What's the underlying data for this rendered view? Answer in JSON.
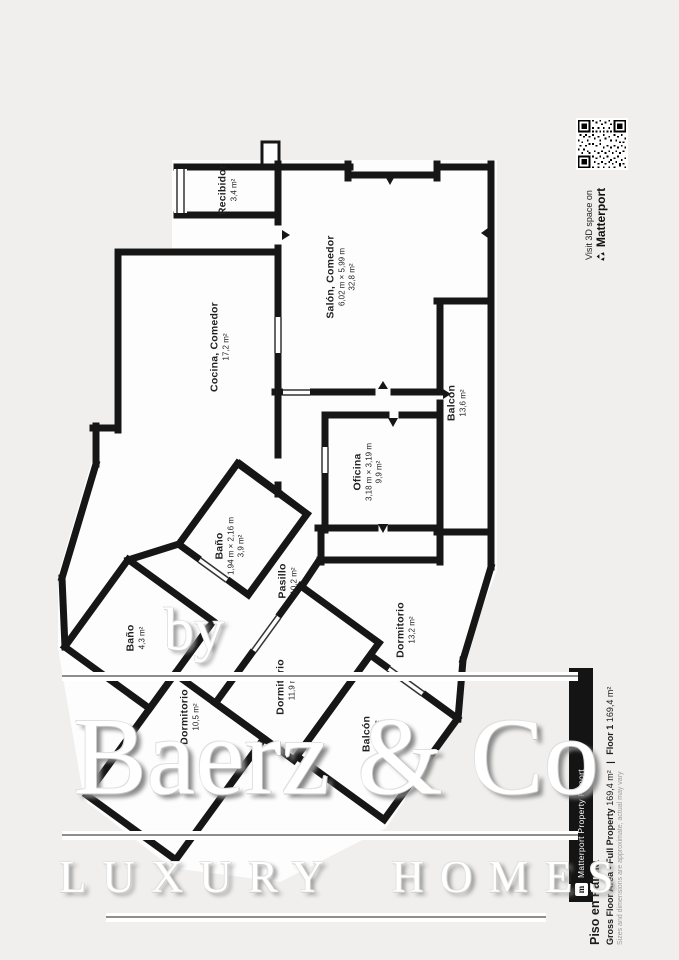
{
  "listing": {
    "title": "Piso en Palma",
    "area_label": "Gross Floor Area - Full Property",
    "area_value": "169,4 m²",
    "divider": "|",
    "floor_label": "Floor 1",
    "floor_value": "169,4 m²",
    "disclaimer": "Sizes and dimensions are approximate, actual may vary"
  },
  "matterport": {
    "visit_line": "Visit 3D space on",
    "brand": "Matterport",
    "banner": "Matterport Property Report",
    "logo_letter": "m"
  },
  "watermark": {
    "prefix": "by",
    "brand": "Baerz & Co",
    "tagline": "LUXURY HOMES"
  },
  "rooms": [
    {
      "name": "Recibidor",
      "dims": "",
      "area": "3,4 m²"
    },
    {
      "name": "Salón, Comedor",
      "dims": "6,02 m × 5,99 m",
      "area": "32,8 m²"
    },
    {
      "name": "Cocina, Comedor",
      "dims": "",
      "area": "17,2 m²"
    },
    {
      "name": "Balcón",
      "dims": "",
      "area": "13,6 m²"
    },
    {
      "name": "Oficina",
      "dims": "3,18 m × 3,19 m",
      "area": "9,9 m²"
    },
    {
      "name": "Baño",
      "dims": "1,94 m × 2,16 m",
      "area": "3,9 m²"
    },
    {
      "name": "Pasillo",
      "dims": "",
      "area": "10,2 m²"
    },
    {
      "name": "Dormitorio",
      "dims": "",
      "area": "13,2 m²"
    },
    {
      "name": "Baño",
      "dims": "",
      "area": "4,3 m²"
    },
    {
      "name": "Dormitorio",
      "dims": "",
      "area": "10,5 m²"
    },
    {
      "name": "Dormitorio",
      "dims": "",
      "area": "11,9 m²"
    },
    {
      "name": "Balcón",
      "dims": "",
      "area": "12,6 m²"
    }
  ]
}
